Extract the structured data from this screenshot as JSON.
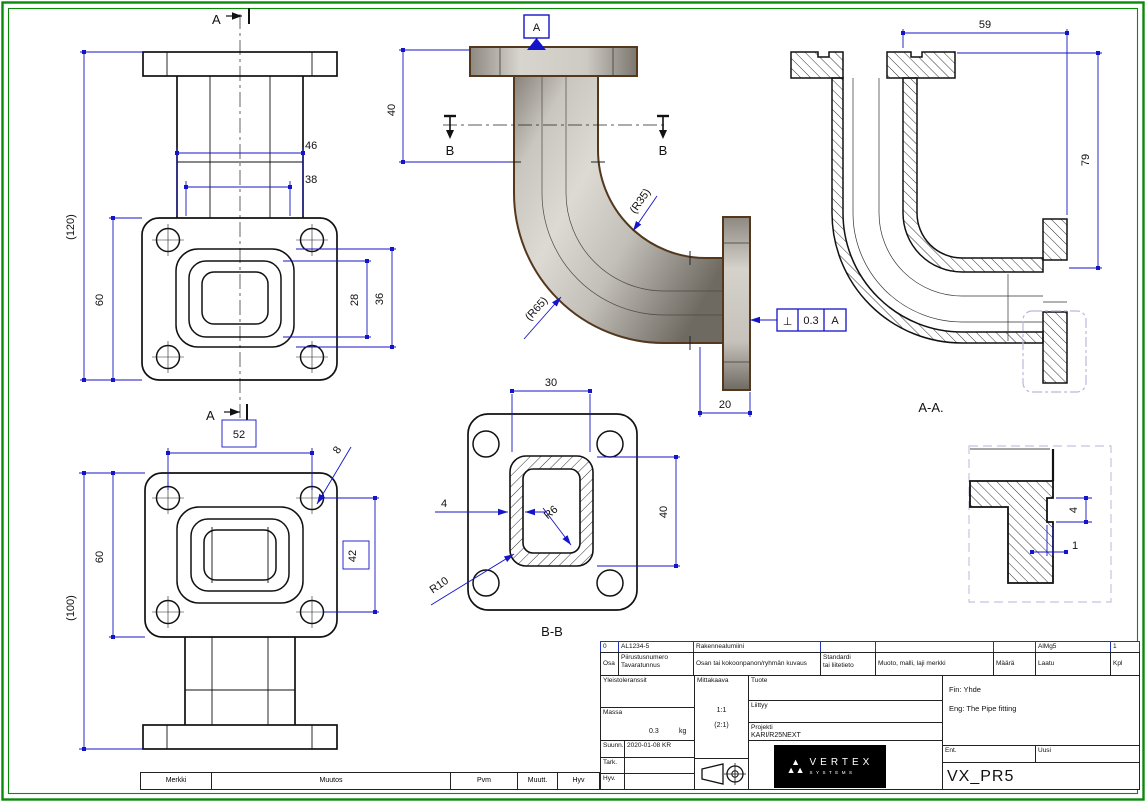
{
  "sheet": {
    "code": "VX_PR5"
  },
  "views": {
    "front_top": {
      "section_top": "A",
      "section_bottom": "A",
      "d46": "46",
      "d38": "38",
      "d120": "(120)",
      "d60": "60",
      "d28": "28",
      "d36": "36"
    },
    "front_bottom": {
      "d52": "52",
      "d8": "8",
      "d60": "60",
      "d100": "(100)",
      "d42": "42"
    },
    "pictorial": {
      "datum": "A",
      "d40": "40",
      "b_left": "B",
      "b_right": "B",
      "r35": "(R35)",
      "r65": "(R65)",
      "d20": "20"
    },
    "tolerance": {
      "symbol": "⊥",
      "value": "0.3",
      "datum": "A"
    },
    "section_bb": {
      "label": "B-B",
      "d30": "30",
      "d4": "4",
      "r6": "R6",
      "r10": "R10",
      "d40": "40"
    },
    "section_aa": {
      "label": "A-A.",
      "d59": "59",
      "d79": "79"
    },
    "detail": {
      "d4": "4",
      "d1": "1"
    }
  },
  "title_block": {
    "parts_row": {
      "pos": "0",
      "code": "AL1234-5",
      "desc": "Rakennealumiini",
      "laatu": "AlMg5",
      "kpl": "1"
    },
    "headers": {
      "osa": "Osa",
      "piirustusnumero": "Piirustusnumero",
      "tavaratunnus": "Tavaratunnus",
      "kuvaus": "Osan tai kokoonpanon/ryhmän kuvaus",
      "standardi1": "Standardi",
      "standardi2": "tai liitetieto",
      "muoto": "Muoto, malli, laji merkki",
      "maara": "Määrä",
      "laatu": "Laatu",
      "kpl": "Kpl"
    },
    "yleistoleranssit": "Yleistoleranssit",
    "massa_label": "Massa",
    "massa_value": "0.3",
    "massa_unit": "kg",
    "mittakaava_label": "Mittakaava",
    "scale_main": "1:1",
    "scale_alt": "(2:1)",
    "suunn_label": "Suunn.",
    "suunn_value": "2020-01-08 KR",
    "tark_label": "Tark.",
    "hyv_label": "Hyv.",
    "tuote_label": "Tuote",
    "liittyy_label": "Liittyy",
    "projekti_label": "Projekti",
    "projekti_value": "KARI/R25NEXT",
    "name_fin": "Fin: Yhde",
    "name_eng": "Eng: The Pipe fitting",
    "ent_label": "Ent.",
    "uusi_label": "Uusi",
    "code": "VX_PR5",
    "logo_brand": "VERTEX",
    "logo_sub": "SYSTEMS",
    "logo_mark": "▲"
  },
  "revision_row": {
    "merkki": "Merkki",
    "muutos": "Muutos",
    "pvm": "Pvm",
    "muutt": "Muutt.",
    "hyv": "Hyv"
  },
  "colors": {
    "dimension": "#1414c8",
    "line": "#111111",
    "frame": "#0a8a0a",
    "shade_light": "#dddad3",
    "shade_dark": "#6e6a62",
    "outline": "#53381d",
    "detail_border": "#c4c4e2"
  }
}
